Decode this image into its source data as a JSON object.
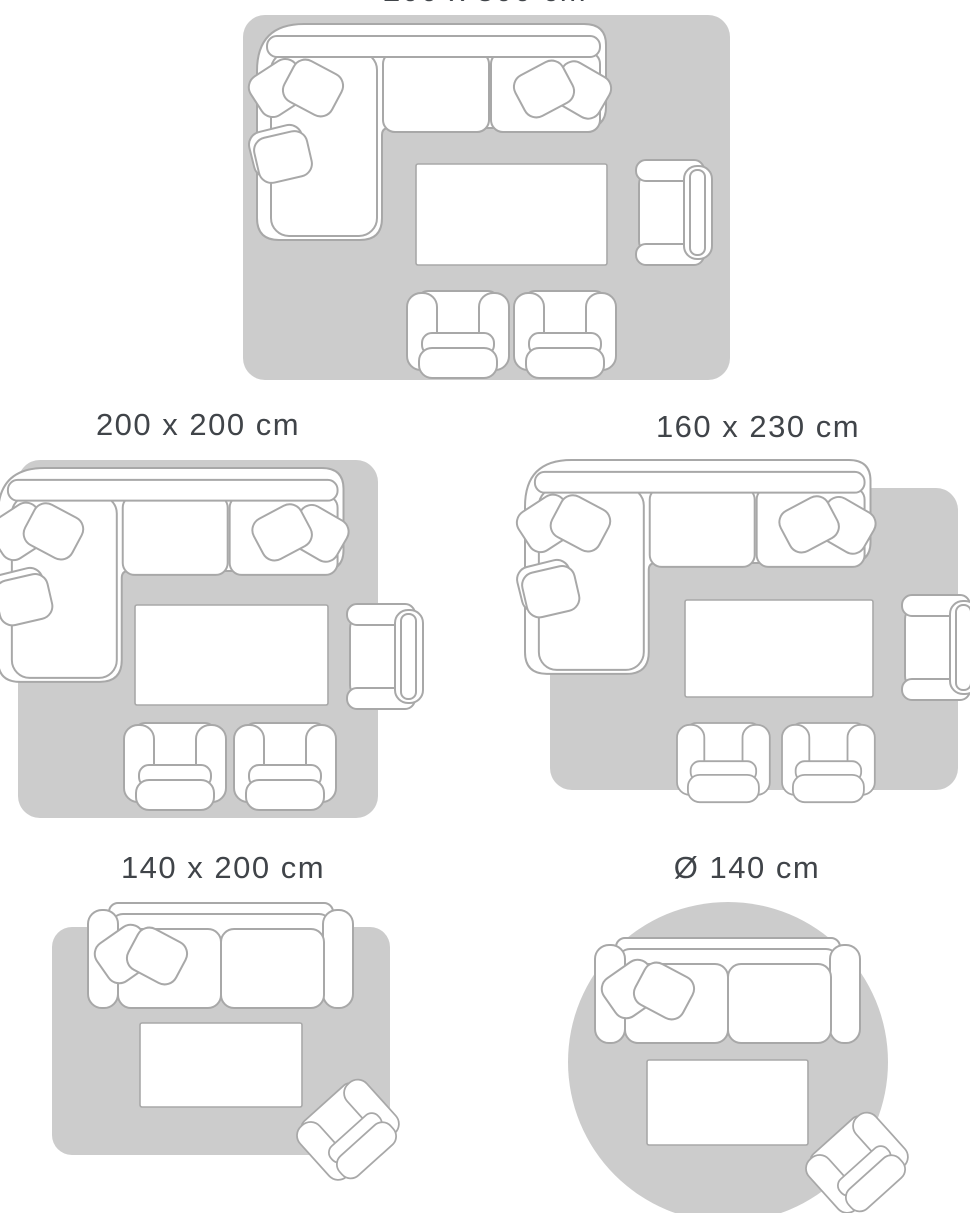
{
  "title": "Rug size guide",
  "colors": {
    "background": "#ffffff",
    "rug": "#cccccc",
    "furniture_outline": "#a8a8a8",
    "furniture_fill": "#ffffff",
    "label_text": "#404449"
  },
  "layouts": [
    {
      "label": "200 x 300 cm",
      "rug_shape": "rectangle",
      "label_cropped_at_top": true,
      "furniture": [
        "corner sofa with cushions",
        "coffee table",
        "armchair",
        "chair",
        "chair"
      ]
    },
    {
      "label": "200 x 200 cm",
      "rug_shape": "square",
      "furniture": [
        "corner sofa with cushions",
        "coffee table",
        "armchair",
        "chair",
        "chair"
      ]
    },
    {
      "label": "160 x 230 cm",
      "rug_shape": "rectangle",
      "furniture": [
        "corner sofa with cushions",
        "coffee table",
        "armchair",
        "chair",
        "chair"
      ]
    },
    {
      "label": "140 x 200 cm",
      "rug_shape": "rectangle",
      "furniture": [
        "two-seat sofa with cushions",
        "coffee table",
        "armchair"
      ]
    },
    {
      "label": "Ø 140 cm",
      "rug_shape": "circle",
      "furniture": [
        "two-seat sofa with cushions",
        "coffee table",
        "armchair"
      ]
    }
  ]
}
